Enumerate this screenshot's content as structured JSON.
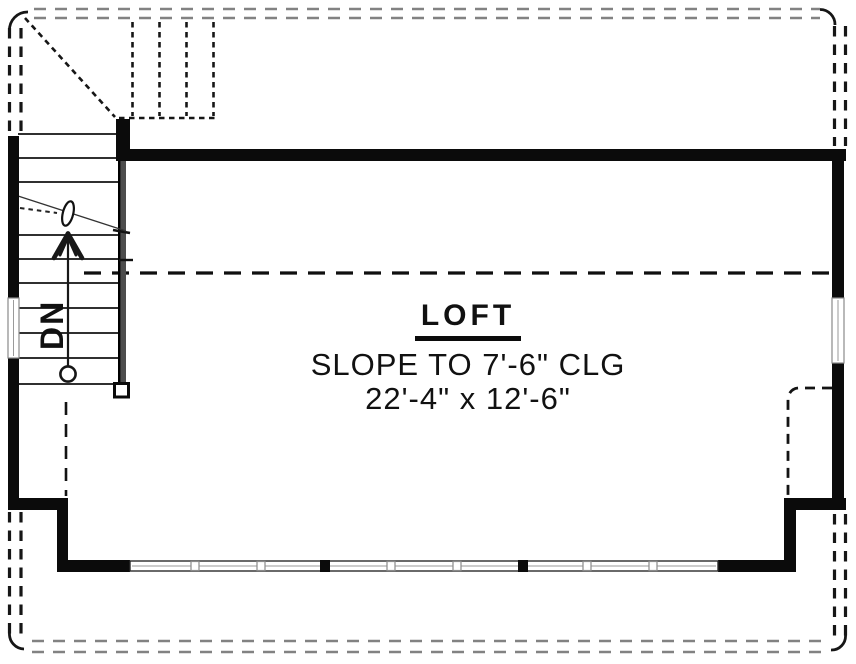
{
  "title": "Loft Floor Plan",
  "labels": {
    "room_name": "LOFT",
    "ceiling_note": "SLOPE TO 7'-6\" CLG",
    "dimensions": "22'-4\" x 12'-6\"",
    "stair_direction": "DN"
  },
  "colors": {
    "wall": "#0b0b0b",
    "line": "#161616",
    "roof_dash": "#828282",
    "stair_wall": "#4d4d4d",
    "background": "#ffffff",
    "ink": "#111111"
  }
}
